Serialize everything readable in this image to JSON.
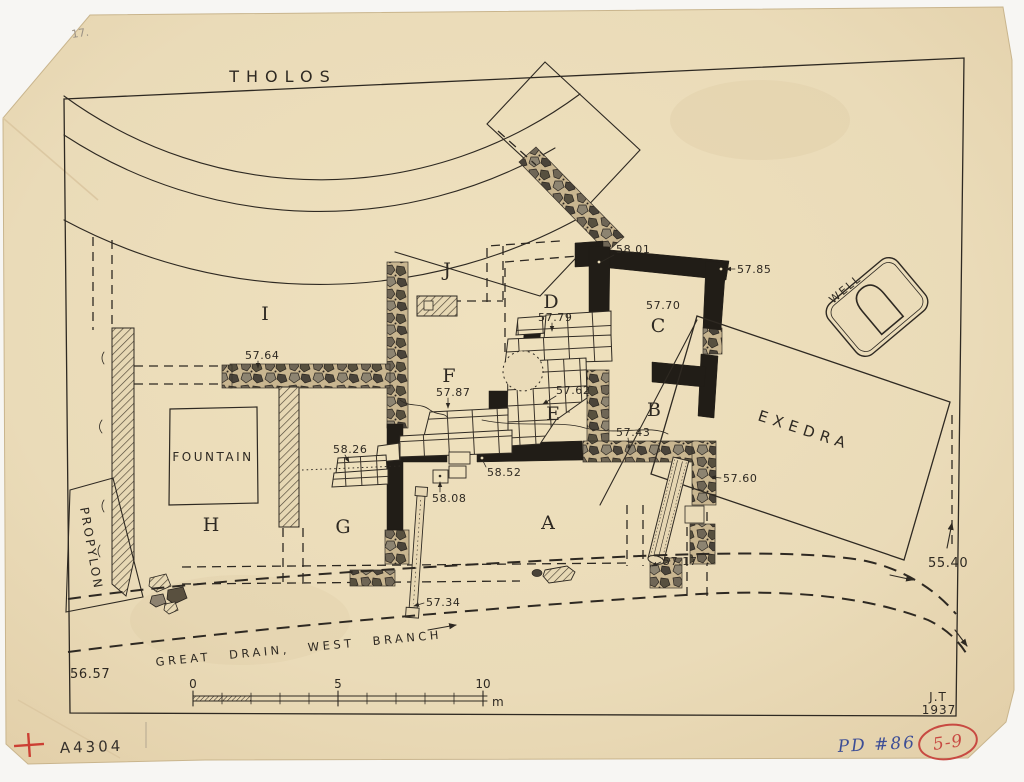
{
  "labels": {
    "tholos": "THOLOS",
    "well": "WELL",
    "exedra": "EXEDRA",
    "fountain": "FOUNTAIN",
    "propylon": "PROPYLON",
    "great_drain": "GREAT DRAIN, WEST BRANCH"
  },
  "rooms": {
    "i": "I",
    "j": "J",
    "d": "D",
    "c": "C",
    "f": "F",
    "e": "E",
    "b": "B",
    "h": "H",
    "g": "G",
    "a": "A"
  },
  "elevations": {
    "e58_01": "58.01",
    "e57_85": "57.85",
    "e57_79": "57.79",
    "e57_70": "57.70",
    "e57_64": "57.64",
    "e57_87": "57.87",
    "e57_62": "57.62",
    "e57_43": "57.43",
    "e58_26": "58.26",
    "e58_52": "58.52",
    "e58_08": "58.08",
    "e57_60": "57.60",
    "e57_34": "57.34",
    "e57_17": "57.17",
    "e55_40": "55.40",
    "e56_57": "56.57"
  },
  "scale_bar": {
    "tick_0": "0",
    "tick_5": "5",
    "tick_10": "10",
    "unit": "m"
  },
  "signature": {
    "initials": "J.T",
    "year": "1937"
  },
  "annotations": {
    "pencil_note": "17.",
    "negative_number": "A4304",
    "pd_number": "PD #86",
    "stamp_number": "5-9"
  },
  "colors": {
    "paper": "#eadbb8",
    "ink": "#2e2922",
    "wall_black": "#211d17",
    "stamp_red": "#c84a42",
    "ink_blue": "#3d4e96",
    "pencil_gray": "#9a9184"
  }
}
